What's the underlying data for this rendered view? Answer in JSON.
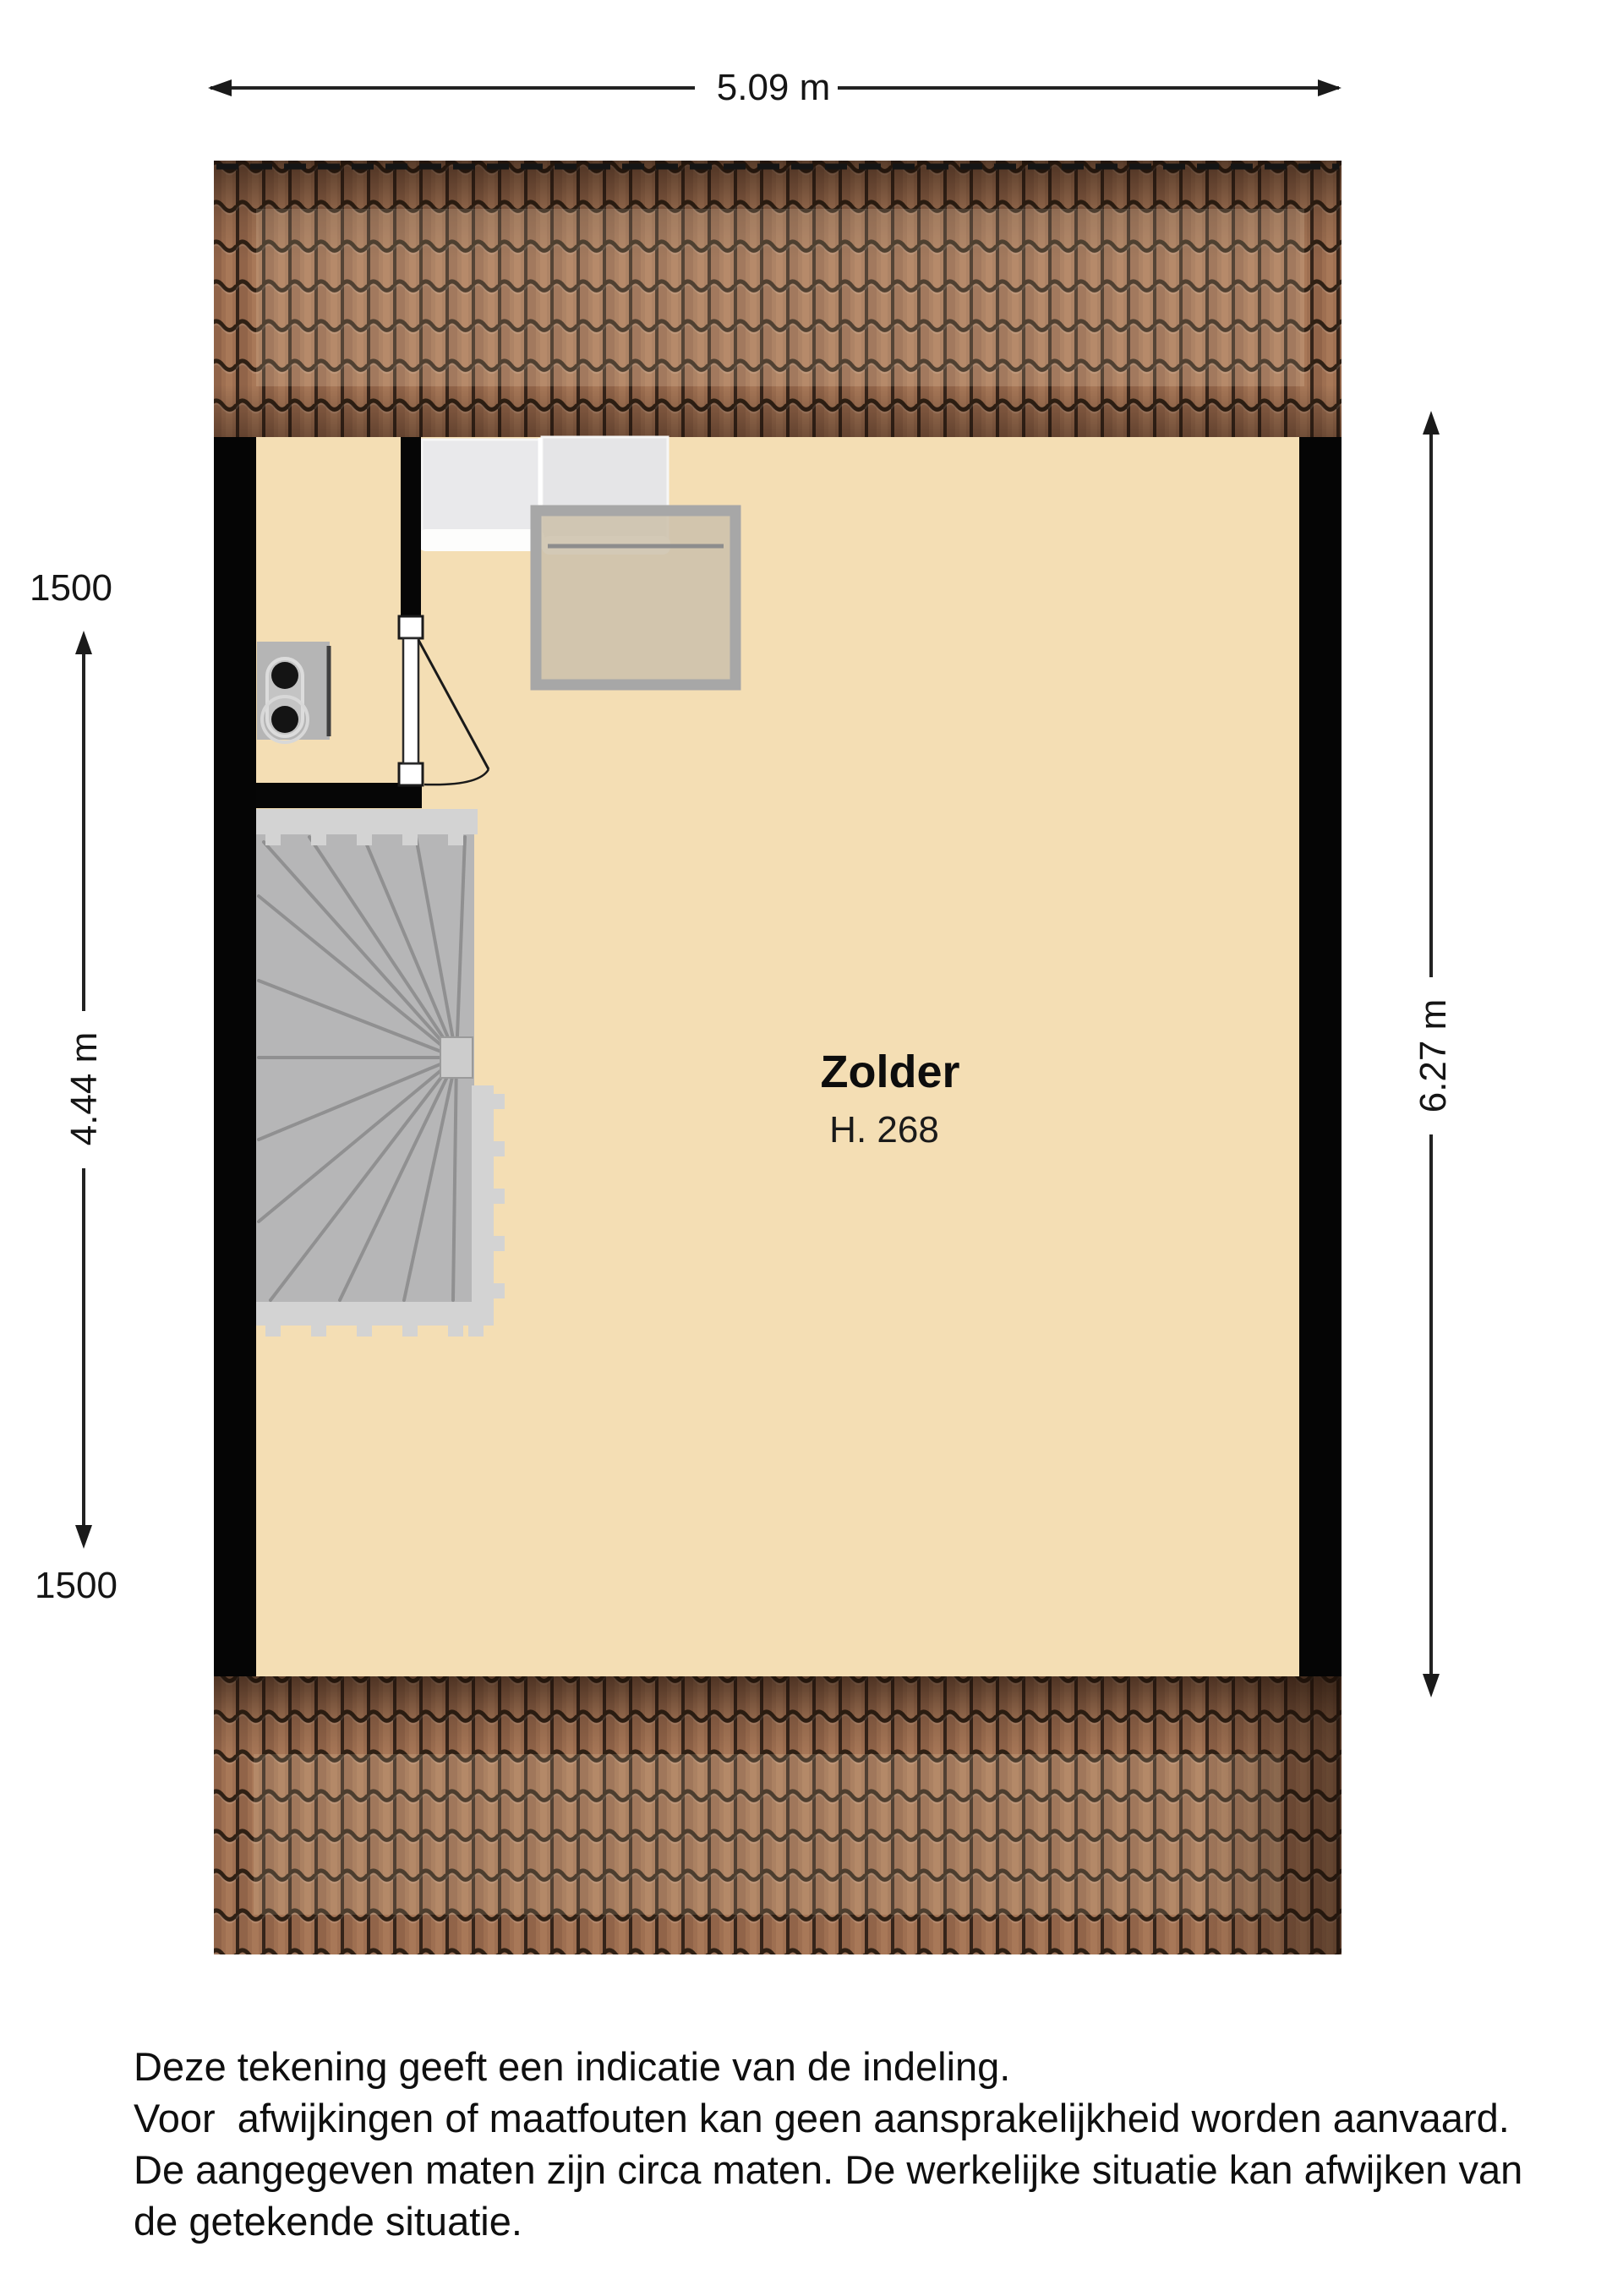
{
  "plan": {
    "room": {
      "name": "Zolder",
      "height_label": "H. 268"
    },
    "dimensions": {
      "width_top": "5.09 m",
      "height_left": "4.44 m",
      "height_right": "6.27 m",
      "knee_wall_top": "1500",
      "knee_wall_bottom": "1500"
    },
    "disclaimer": {
      "line1": "Deze tekening geeft een indicatie van de indeling.",
      "line2": "Voor  afwijkingen of maatfouten kan geen aansprakelijkheid worden aanvaard.",
      "line3": "De aangegeven maten zijn circa maten. De werkelijke situatie kan afwijken van",
      "line4": "de getekende situatie."
    },
    "colors": {
      "floor": "#f4deb4",
      "wall": "#000000",
      "roof_tile": "#9e6f51",
      "roof_joint": "#33231a",
      "stairs": "#b6b6b7",
      "stair_rail": "#d3d3d3",
      "skylight_frame": "#a7a7a7",
      "skylight_glass": "#cdc2ac",
      "cabinet": "#e8e8ea",
      "dimension_line": "#222222"
    }
  }
}
